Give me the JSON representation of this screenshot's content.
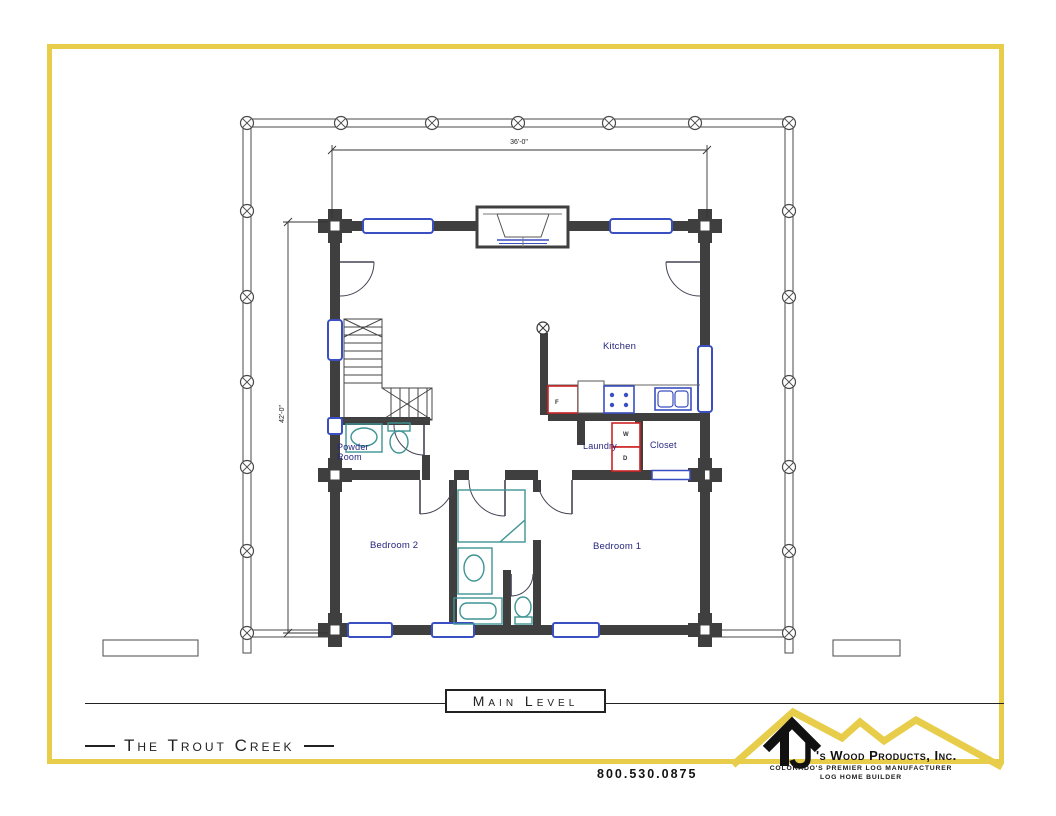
{
  "plan": {
    "level_title": "Main Level",
    "plan_title": "The Trout Creek",
    "rooms": {
      "kitchen": "Kitchen",
      "laundry": "Laundry",
      "closet": "Closet",
      "powder_line1": "Powder",
      "powder_line2": "Room",
      "bedroom1": "Bedroom 1",
      "bedroom2": "Bedroom 2"
    },
    "appliances": {
      "refrigerator": "F",
      "washer": "W",
      "dryer": "D"
    },
    "dimensions": {
      "overall_width": "36'-0\"",
      "overall_depth": "42'-0\""
    }
  },
  "branding": {
    "company_mark": "TJ",
    "company_suffix": "'s Wood Products, Inc.",
    "tagline_line1": "COLORADO'S PREMIER LOG MANUFACTURER",
    "tagline_line2": "LOG HOME BUILDER",
    "phone": "800.530.0875"
  },
  "colors": {
    "frame_yellow": "#e7cd49",
    "wall_gray": "#3f3f3f",
    "window_blue": "#3a4fc1",
    "label_navy": "#26267e",
    "appliance_red": "#cc2222",
    "fixture_teal": "#3e9494"
  }
}
